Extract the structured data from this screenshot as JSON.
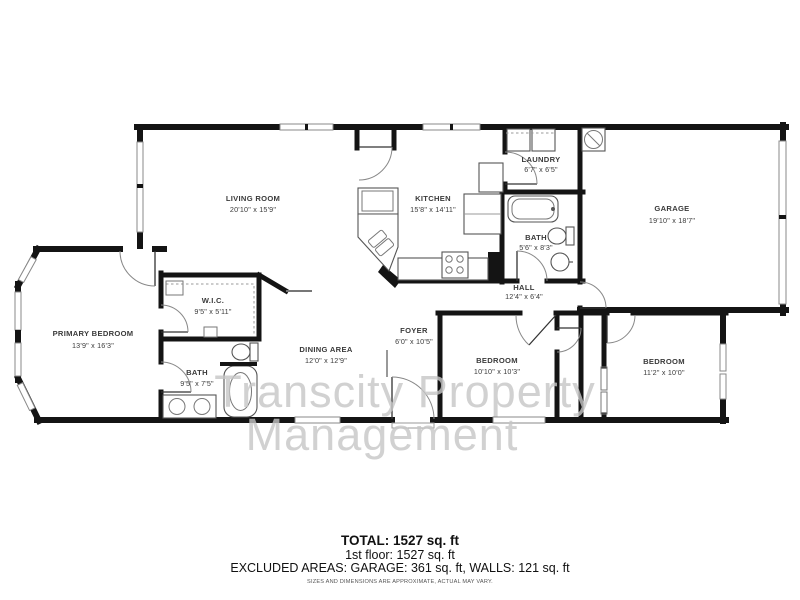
{
  "floorplan": {
    "rooms": {
      "living": {
        "name": "LIVING ROOM",
        "dims": "20'10\" x 15'9\""
      },
      "kitchen": {
        "name": "KITCHEN",
        "dims": "15'8\" x 14'11\""
      },
      "laundry": {
        "name": "LAUNDRY",
        "dims": "6'7\" x 6'5\""
      },
      "garage": {
        "name": "GARAGE",
        "dims": "19'10\" x 18'7\""
      },
      "bath_small": {
        "name": "BATH",
        "dims": "5'6\" x 8'3\""
      },
      "hall": {
        "name": "HALL",
        "dims": "12'4\" x 6'4\""
      },
      "wic": {
        "name": "W.I.C.",
        "dims": "9'5\" x 5'11\""
      },
      "primary": {
        "name": "PRIMARY BEDROOM",
        "dims": "13'9\" x 16'3\""
      },
      "bath_primary": {
        "name": "BATH",
        "dims": "9'5\" x 7'5\""
      },
      "dining": {
        "name": "DINING AREA",
        "dims": "12'0\" x 12'9\""
      },
      "foyer": {
        "name": "FOYER",
        "dims": "6'0\" x 10'5\""
      },
      "bedroom1": {
        "name": "BEDROOM",
        "dims": "10'10\" x 10'3\""
      },
      "bedroom2": {
        "name": "BEDROOM",
        "dims": "11'2\" x 10'0\""
      }
    },
    "watermark": {
      "line1": "Transcity Property",
      "line2": "Management"
    },
    "summary": {
      "total": "TOTAL: 1527 sq. ft",
      "floor1": "1st floor: 1527 sq. ft",
      "excluded": "EXCLUDED AREAS: GARAGE: 361 sq. ft, WALLS: 121 sq. ft",
      "disclaimer": "SIZES AND DIMENSIONS ARE APPROXIMATE, ACTUAL MAY VARY."
    },
    "colors": {
      "wall": "#141414",
      "watermark": "#c6c6c6"
    }
  }
}
